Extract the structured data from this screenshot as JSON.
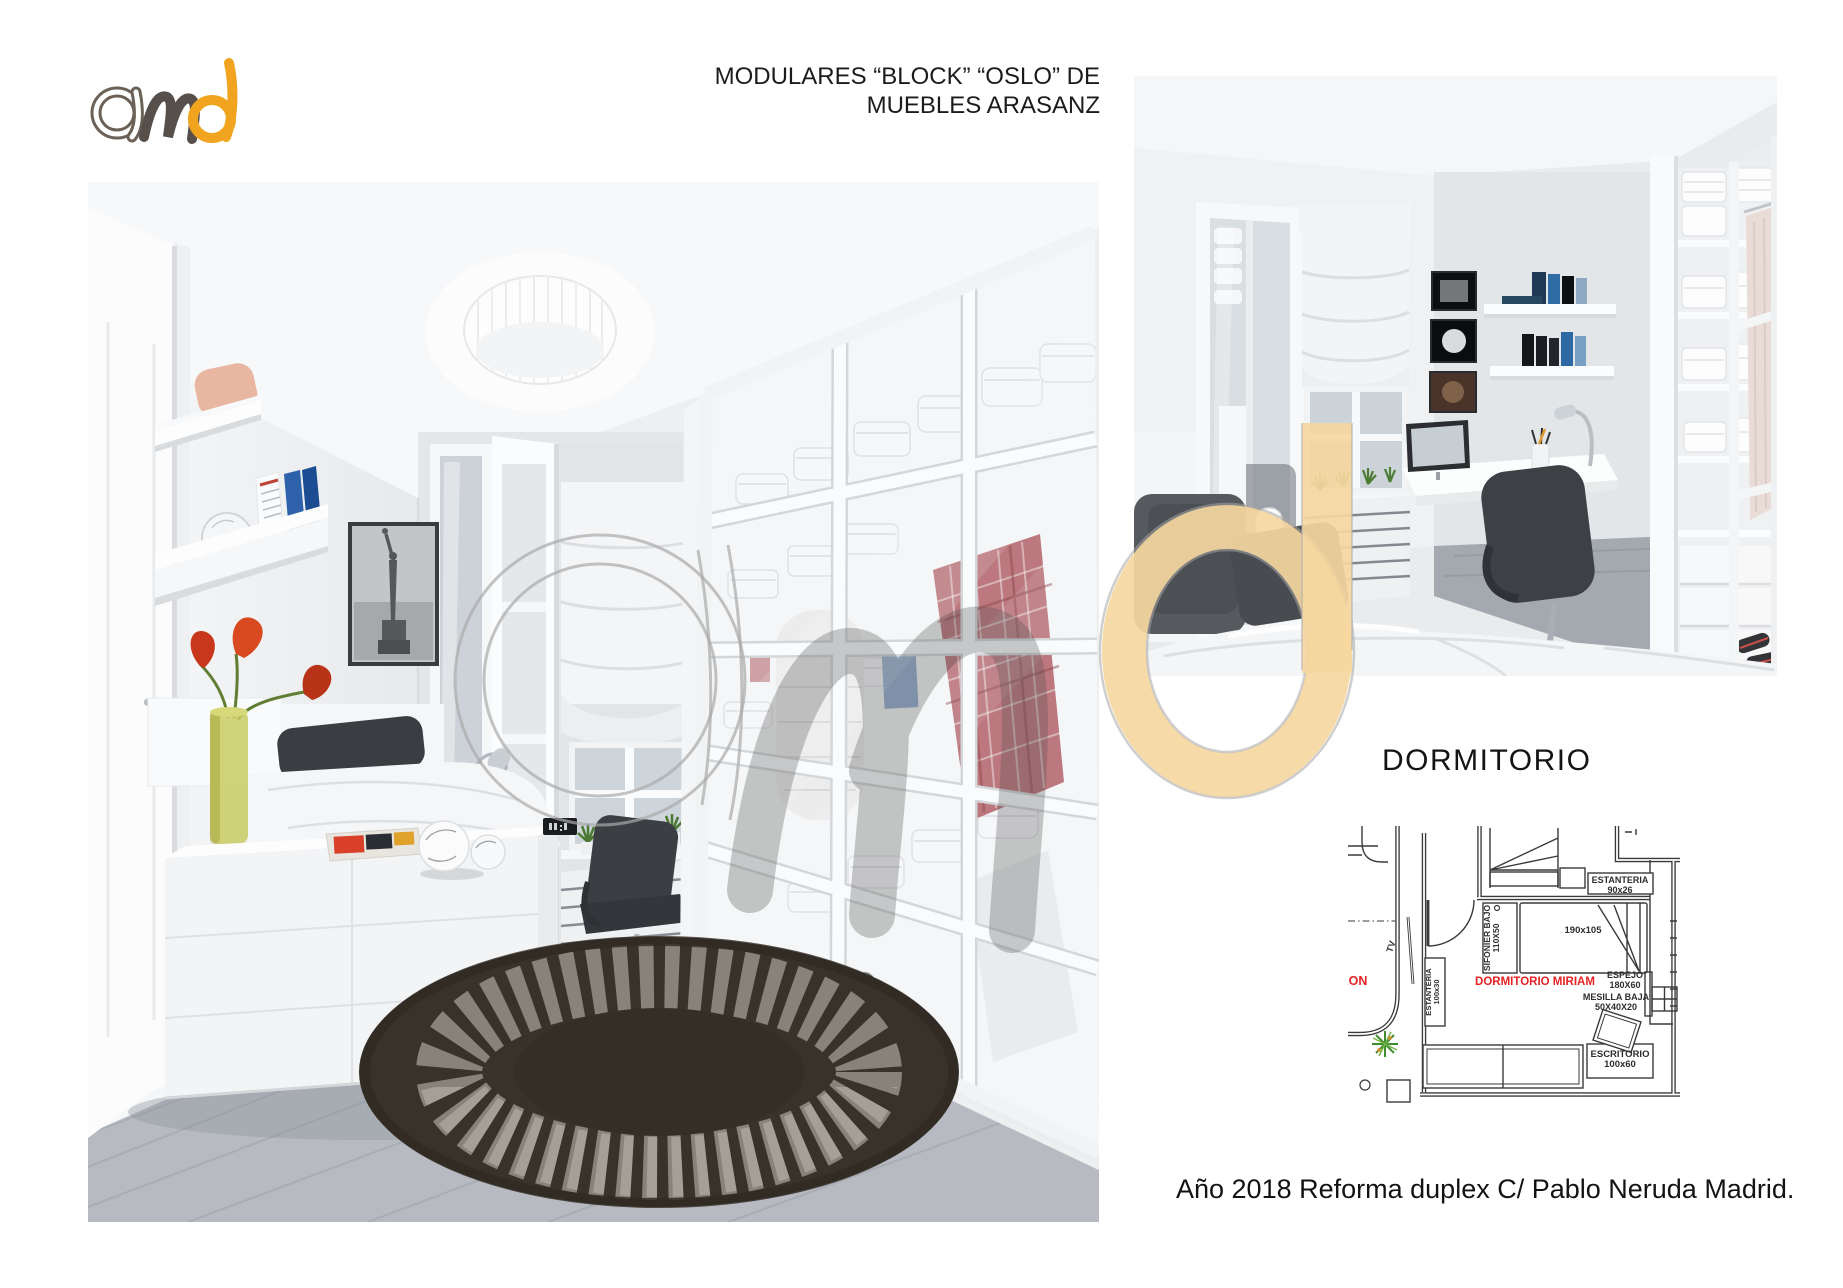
{
  "header": {
    "title_line1": "MODULARES “BLOCK” “OSLO” DE",
    "title_line2": "MUEBLES ARASANZ"
  },
  "logo": {
    "text": "amd",
    "color_outline": "#6b6156",
    "color_m": "#57504a",
    "color_d": "#f0a41f"
  },
  "watermark": {
    "text": "amd",
    "color_beige": "#f5d7a0",
    "color_grey": "#a9a9a9"
  },
  "section": {
    "heading": "DORMITORIO"
  },
  "footer": {
    "caption": "Año 2018 Reforma duplex C/ Pablo Neruda Madrid."
  },
  "floor_plan": {
    "room_label": "DORMITORIO MIRIAM",
    "adjacent_room_label": "LON",
    "bed_size": "190x105",
    "labels": {
      "estanteria_top": {
        "line1": "ESTANTERIA",
        "line2": "90x26"
      },
      "sifonier": {
        "line1": "SIFONIER BAJO",
        "line2": "110X50"
      },
      "espejo": {
        "line1": "ESPEJO",
        "line2": "180X60"
      },
      "mesilla": {
        "line1": "MESILLA BAJA",
        "line2": "50X40X20"
      },
      "escritorio": {
        "line1": "ESCRITORIO",
        "line2": "100x60"
      },
      "estanteria_left": {
        "line1": "ESTANTERIA",
        "line2": "100x30"
      },
      "tv": "TV"
    },
    "colors": {
      "line": "#3a3a3a",
      "label_red": "#e62225"
    }
  }
}
